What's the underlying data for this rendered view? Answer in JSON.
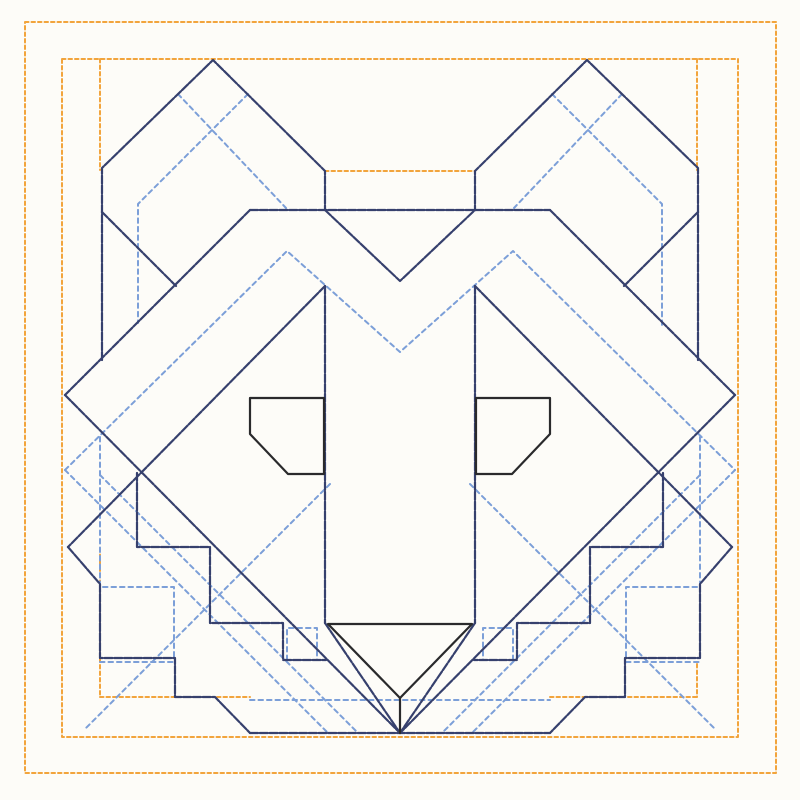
{
  "canvas": {
    "width": 800,
    "height": 800,
    "background": "#fdfcf8"
  },
  "palette": {
    "orange": "#f2a43c",
    "navy": "#36406d",
    "blue": "#7c9fd8",
    "black": "#2a2a2c"
  },
  "layers": [
    {
      "name": "border-orange-layer",
      "color": "orange",
      "width": 2,
      "dash": "3.5 3",
      "paths": [
        {
          "name": "outer-frame",
          "closed": true,
          "points": [
            [
              25,
              22
            ],
            [
              776,
              22
            ],
            [
              776,
              773
            ],
            [
              25,
              773
            ]
          ]
        },
        {
          "name": "middle-frame",
          "closed": true,
          "points": [
            [
              62,
              59
            ],
            [
              738,
              59
            ],
            [
              738,
              737
            ],
            [
              62,
              737
            ]
          ]
        },
        {
          "name": "inner-frame-left-upper",
          "closed": false,
          "points": [
            [
              100,
              59
            ],
            [
              100,
              170
            ]
          ]
        },
        {
          "name": "inner-frame-left-lower",
          "closed": false,
          "points": [
            [
              100,
              548
            ],
            [
              100,
              697
            ]
          ]
        },
        {
          "name": "inner-frame-right-upper",
          "closed": false,
          "points": [
            [
              697,
              59
            ],
            [
              697,
              170
            ]
          ]
        },
        {
          "name": "inner-frame-right-lower",
          "closed": false,
          "points": [
            [
              697,
              664
            ],
            [
              697,
              697
            ]
          ]
        },
        {
          "name": "inner-frame-bottom-left",
          "closed": false,
          "points": [
            [
              100,
              697
            ],
            [
              250,
              697
            ]
          ]
        },
        {
          "name": "inner-frame-bottom-right",
          "closed": false,
          "points": [
            [
              550,
              697
            ],
            [
              697,
              697
            ]
          ]
        },
        {
          "name": "head-top-seam",
          "closed": false,
          "points": [
            [
              325,
              171
            ],
            [
              475,
              171
            ]
          ]
        }
      ]
    },
    {
      "name": "echo-blue-layer",
      "color": "blue",
      "width": 2,
      "dash": "4.5 4",
      "paths": [
        {
          "name": "ear-echo-left-a",
          "closed": false,
          "points": [
            [
              178,
              94
            ],
            [
              286,
              208
            ]
          ]
        },
        {
          "name": "ear-echo-left-b",
          "closed": false,
          "points": [
            [
              248,
              94
            ],
            [
              138,
              204
            ],
            [
              138,
              323
            ]
          ]
        },
        {
          "name": "ear-echo-right-a",
          "closed": false,
          "points": [
            [
              622,
              94
            ],
            [
              514,
              208
            ]
          ]
        },
        {
          "name": "ear-echo-right-b",
          "closed": false,
          "points": [
            [
              552,
              94
            ],
            [
              662,
              204
            ],
            [
              662,
              326
            ]
          ]
        },
        {
          "name": "brow-echo-zigzag",
          "closed": false,
          "points": [
            [
              65,
              470
            ],
            [
              287,
              251
            ],
            [
              400,
              352
            ],
            [
              513,
              251
            ],
            [
              735,
              470
            ]
          ]
        },
        {
          "name": "diamond-echo-left",
          "closed": false,
          "points": [
            [
              65,
              470
            ],
            [
              328,
              733
            ]
          ]
        },
        {
          "name": "diamond-echo-left-inner",
          "closed": false,
          "points": [
            [
              100,
              475
            ],
            [
              358,
              733
            ]
          ]
        },
        {
          "name": "diamond-echo-right",
          "closed": false,
          "points": [
            [
              735,
              470
            ],
            [
              472,
              733
            ]
          ]
        },
        {
          "name": "diamond-echo-right-inner",
          "closed": false,
          "points": [
            [
              700,
              475
            ],
            [
              442,
              733
            ]
          ]
        },
        {
          "name": "jaw-echo-left",
          "closed": false,
          "points": [
            [
              330,
              484
            ],
            [
              85,
              729
            ]
          ]
        },
        {
          "name": "jaw-echo-right",
          "closed": false,
          "points": [
            [
              470,
              484
            ],
            [
              715,
              729
            ]
          ]
        },
        {
          "name": "step-echo-left",
          "closed": false,
          "points": [
            [
              100,
              437
            ],
            [
              100,
              587
            ],
            [
              174,
              587
            ],
            [
              174,
              660
            ]
          ]
        },
        {
          "name": "step-echo-left-foot",
          "closed": false,
          "points": [
            [
              100,
              662
            ],
            [
              174,
              662
            ]
          ]
        },
        {
          "name": "step-echo-right",
          "closed": false,
          "points": [
            [
              700,
              437
            ],
            [
              700,
              587
            ],
            [
              626,
              587
            ],
            [
              626,
              660
            ]
          ]
        },
        {
          "name": "step-echo-right-foot",
          "closed": false,
          "points": [
            [
              626,
              662
            ],
            [
              700,
              662
            ]
          ]
        },
        {
          "name": "notch-echo-left",
          "closed": false,
          "points": [
            [
              287,
              660
            ],
            [
              287,
              628
            ],
            [
              317,
              628
            ],
            [
              317,
              660
            ]
          ]
        },
        {
          "name": "notch-echo-right",
          "closed": false,
          "points": [
            [
              513,
              660
            ],
            [
              513,
              628
            ],
            [
              483,
              628
            ],
            [
              483,
              660
            ]
          ]
        },
        {
          "name": "chin-echo",
          "closed": false,
          "points": [
            [
              250,
              700
            ],
            [
              550,
              700
            ]
          ]
        }
      ]
    },
    {
      "name": "face-navy-layer",
      "color": "navy",
      "width": 2.2,
      "dash": "8 1.8",
      "paths": [
        {
          "name": "ear-left",
          "closed": false,
          "points": [
            [
              102,
              360
            ],
            [
              102,
              168
            ],
            [
              213,
              60
            ],
            [
              325,
              171
            ],
            [
              325,
              210
            ]
          ]
        },
        {
          "name": "ear-right",
          "closed": false,
          "points": [
            [
              698,
              360
            ],
            [
              698,
              168
            ],
            [
              587,
              60
            ],
            [
              475,
              171
            ],
            [
              475,
              210
            ]
          ]
        },
        {
          "name": "inner-ear-left",
          "closed": false,
          "points": [
            [
              102,
              212
            ],
            [
              176,
              286
            ]
          ]
        },
        {
          "name": "inner-ear-right",
          "closed": false,
          "points": [
            [
              698,
              212
            ],
            [
              624,
              286
            ]
          ]
        },
        {
          "name": "brow-shelf",
          "closed": false,
          "points": [
            [
              250,
              210
            ],
            [
              550,
              210
            ]
          ]
        },
        {
          "name": "brow-v",
          "closed": false,
          "points": [
            [
              325,
              210
            ],
            [
              400,
              281
            ],
            [
              475,
              210
            ]
          ]
        },
        {
          "name": "cheek-left",
          "closed": false,
          "points": [
            [
              250,
              210
            ],
            [
              65,
              395
            ]
          ]
        },
        {
          "name": "cheek-right",
          "closed": false,
          "points": [
            [
              550,
              210
            ],
            [
              735,
              395
            ]
          ]
        },
        {
          "name": "face-diamond-left",
          "closed": false,
          "points": [
            [
              65,
              395
            ],
            [
              400,
              733
            ]
          ]
        },
        {
          "name": "face-diamond-right",
          "closed": false,
          "points": [
            [
              735,
              395
            ],
            [
              400,
              733
            ]
          ]
        },
        {
          "name": "jaw-left",
          "closed": false,
          "points": [
            [
              325,
              286
            ],
            [
              68,
              547
            ]
          ]
        },
        {
          "name": "jaw-right",
          "closed": false,
          "points": [
            [
              475,
              286
            ],
            [
              732,
              547
            ]
          ]
        },
        {
          "name": "muzzle-side-left",
          "closed": false,
          "points": [
            [
              325,
              286
            ],
            [
              325,
              623
            ]
          ]
        },
        {
          "name": "muzzle-side-right",
          "closed": false,
          "points": [
            [
              475,
              286
            ],
            [
              475,
              623
            ]
          ]
        },
        {
          "name": "muzzle-v-left",
          "closed": false,
          "points": [
            [
              325,
              623
            ],
            [
              400,
              733
            ]
          ]
        },
        {
          "name": "muzzle-v-right",
          "closed": false,
          "points": [
            [
              475,
              623
            ],
            [
              400,
              733
            ]
          ]
        },
        {
          "name": "stair-inner-left",
          "closed": false,
          "points": [
            [
              137,
              473
            ],
            [
              137,
              547
            ],
            [
              210,
              547
            ],
            [
              210,
              623
            ],
            [
              283,
              623
            ],
            [
              283,
              660
            ],
            [
              326,
              660
            ]
          ]
        },
        {
          "name": "stair-inner-right",
          "closed": false,
          "points": [
            [
              663,
              473
            ],
            [
              663,
              547
            ],
            [
              590,
              547
            ],
            [
              590,
              623
            ],
            [
              517,
              623
            ],
            [
              517,
              660
            ],
            [
              474,
              660
            ]
          ]
        },
        {
          "name": "stair-outer-left",
          "closed": false,
          "points": [
            [
              68,
              547
            ],
            [
              100,
              584
            ],
            [
              100,
              658
            ],
            [
              175,
              658
            ],
            [
              175,
              697
            ],
            [
              215,
              697
            ],
            [
              250,
              733
            ]
          ]
        },
        {
          "name": "stair-outer-right",
          "closed": false,
          "points": [
            [
              732,
              547
            ],
            [
              700,
              584
            ],
            [
              700,
              658
            ],
            [
              625,
              658
            ],
            [
              625,
              697
            ],
            [
              585,
              697
            ],
            [
              550,
              733
            ]
          ]
        },
        {
          "name": "chin-line",
          "closed": false,
          "points": [
            [
              250,
              733
            ],
            [
              550,
              733
            ]
          ]
        }
      ]
    },
    {
      "name": "features-black-layer",
      "color": "black",
      "width": 2.2,
      "dash": "",
      "paths": [
        {
          "name": "eye-left",
          "closed": true,
          "points": [
            [
              250,
              398
            ],
            [
              324,
              398
            ],
            [
              324,
              474
            ],
            [
              288,
              474
            ],
            [
              250,
              434
            ]
          ]
        },
        {
          "name": "eye-right",
          "closed": true,
          "points": [
            [
              476,
              398
            ],
            [
              550,
              398
            ],
            [
              550,
              434
            ],
            [
              512,
              474
            ],
            [
              476,
              474
            ]
          ]
        },
        {
          "name": "nose",
          "closed": true,
          "points": [
            [
              328,
              624
            ],
            [
              472,
              624
            ],
            [
              400,
              698
            ]
          ]
        },
        {
          "name": "nose-chin-line",
          "closed": false,
          "points": [
            [
              400,
              698
            ],
            [
              400,
              733
            ]
          ]
        }
      ]
    }
  ]
}
